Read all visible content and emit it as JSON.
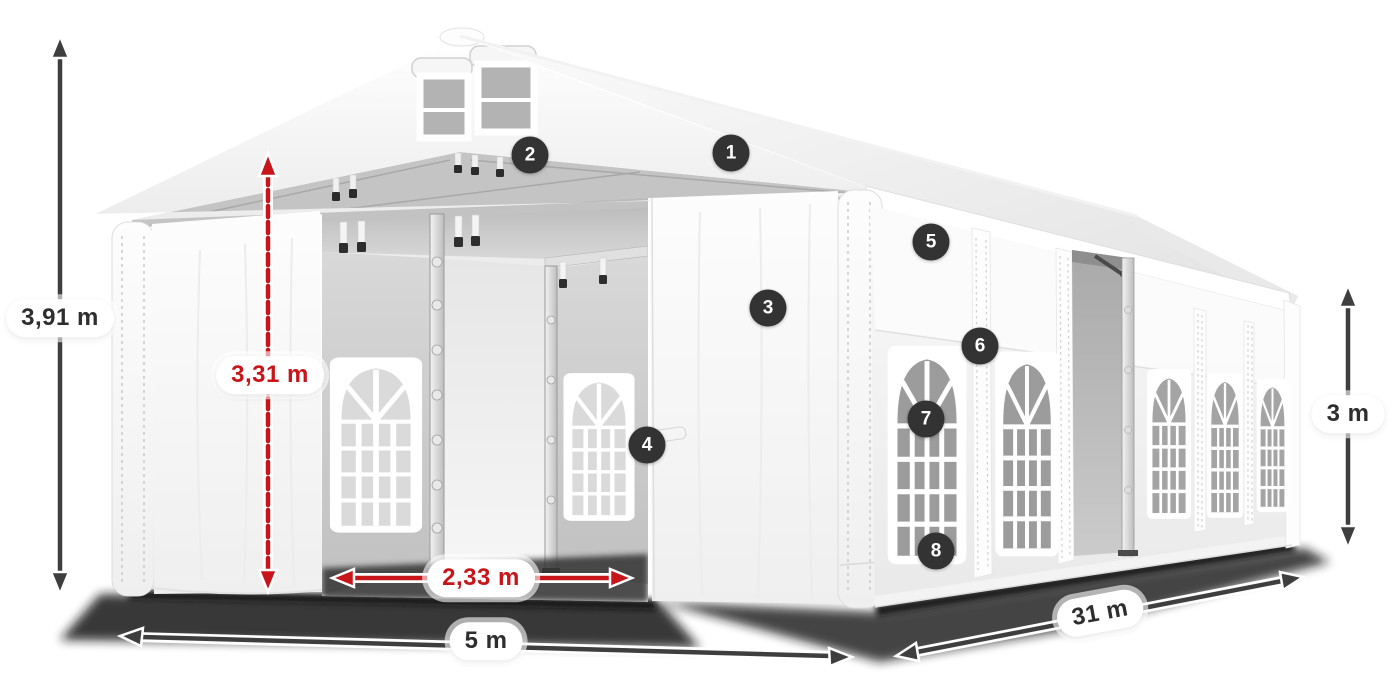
{
  "diagram": {
    "subject": "white-marquee-tent-dimension-diagram",
    "background": "#ffffff"
  },
  "dimensions": {
    "total_height": {
      "label": "3,91 m",
      "style": "dark"
    },
    "entrance_height": {
      "label": "3,31 m",
      "style": "red"
    },
    "entrance_width": {
      "label": "2,33 m",
      "style": "red"
    },
    "width": {
      "label": "5 m",
      "style": "dark"
    },
    "length": {
      "label": "31 m",
      "style": "dark"
    },
    "side_height": {
      "label": "3 m",
      "style": "dark"
    }
  },
  "markers": [
    {
      "number": "1"
    },
    {
      "number": "2"
    },
    {
      "number": "3"
    },
    {
      "number": "4"
    },
    {
      "number": "5"
    },
    {
      "number": "6"
    },
    {
      "number": "7"
    },
    {
      "number": "8"
    }
  ],
  "colors": {
    "accent_red": "#c8151a",
    "arrow_dark": "#3e3e3e",
    "marker_bg": "#333333",
    "marker_text": "#ffffff",
    "label_text": "#2e2e2e",
    "tent_white": "#ffffff",
    "interior_gray": "#c4c4c4",
    "window_glass": "#9e9e9e",
    "shadow": "#161616"
  }
}
